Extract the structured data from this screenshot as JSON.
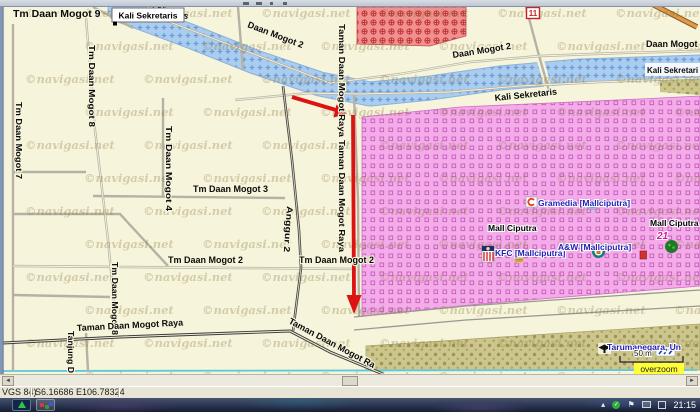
{
  "map": {
    "watermark": "©navigasi.net",
    "tooltip": {
      "label": "Kali Sekretaris"
    },
    "route_shield": "11",
    "river_label_box": {
      "text": "Kali Sekretari"
    },
    "road_labels": [
      {
        "id": "tm-daan-mogot-9",
        "text": "Tm Daan Mogot 9",
        "x": 13,
        "y": 17,
        "rot": 0,
        "size": 10.5
      },
      {
        "id": "kali-sekretaris-top",
        "text": "Kali Sekretaris",
        "x": 128,
        "y": 0,
        "rot": 18,
        "size": 9
      },
      {
        "id": "daan-mogot-2-a",
        "text": "Daan Mogot 2",
        "x": 247,
        "y": 27,
        "rot": 21,
        "size": 9
      },
      {
        "id": "daan-mogot-2-b",
        "text": "Daan Mogot 2",
        "x": 453,
        "y": 58,
        "rot": -9,
        "size": 9
      },
      {
        "id": "daan-mogot-2-c",
        "text": "Daan Mogot 2",
        "x": 646,
        "y": 47,
        "rot": 0,
        "size": 9
      },
      {
        "id": "kali-sekretaris-south",
        "text": "Kali Sekretaris",
        "x": 495,
        "y": 101,
        "rot": -6,
        "size": 9
      },
      {
        "id": "tm-daan-mogot-8-upper",
        "text": "Tm Daan Mogot 8",
        "x": 89,
        "y": 45,
        "rot": 90,
        "size": 8,
        "len": 82
      },
      {
        "id": "tm-daan-mogot-8-lower",
        "text": "Tm Daan Mogot 8",
        "x": 112,
        "y": 262,
        "rot": 90,
        "size": 8,
        "len": 73
      },
      {
        "id": "tm-daan-mogot-7",
        "text": "Tm Daan Mogot 7",
        "x": 16,
        "y": 102,
        "rot": 90,
        "size": 8,
        "len": 77
      },
      {
        "id": "tm-daan-mogot-4",
        "text": "Tm Daan Mogot 4",
        "x": 166,
        "y": 126,
        "rot": 90,
        "size": 8,
        "len": 85
      },
      {
        "id": "tm-daan-mogot-3",
        "text": "Tm Daan Mogot 3",
        "x": 193,
        "y": 192,
        "rot": 0,
        "size": 9
      },
      {
        "id": "tm-daan-mogot-2-a",
        "text": "Tm Daan Mogot 2",
        "x": 168,
        "y": 263,
        "rot": 0,
        "size": 9
      },
      {
        "id": "tm-daan-mogot-2-b",
        "text": "Tm Daan Mogot 2",
        "x": 299,
        "y": 263,
        "rot": 0,
        "size": 9
      },
      {
        "id": "taman-daan-mogot-raya-vert-a",
        "text": "Taman Daan Mogot Raya",
        "x": 339,
        "y": 24,
        "rot": 90,
        "size": 8,
        "len": 113
      },
      {
        "id": "taman-daan-mogot-raya-vert-b",
        "text": "Taman Daan Mogot Raya",
        "x": 339,
        "y": 140,
        "rot": 90,
        "size": 8,
        "len": 112
      },
      {
        "id": "anggur-2",
        "text": "Anggur 2",
        "x": 287,
        "y": 206,
        "rot": 94,
        "size": 8.5,
        "len": 46
      },
      {
        "id": "tanjung-d",
        "text": "Tanjung D",
        "x": 68,
        "y": 331,
        "rot": 90,
        "size": 8,
        "len": 42
      },
      {
        "id": "taman-daan-mogot-raya-horiz",
        "text": "Taman Daan Mogot Raya",
        "x": 77,
        "y": 331,
        "rot": -3,
        "size": 9
      },
      {
        "id": "taman-daan-mogot-raya-diag",
        "text": "Taman Daan Mogot Ra",
        "x": 288,
        "y": 323,
        "rot": 28,
        "size": 9
      }
    ],
    "pois": [
      {
        "id": "gramedia",
        "text": "Gramedia [Mallciputra]",
        "x": 538,
        "y": 206,
        "color": "navy"
      },
      {
        "id": "mall-ciputra-1",
        "text": "Mall Ciputra",
        "x": 488,
        "y": 231,
        "color": "black"
      },
      {
        "id": "kfc",
        "text": "KFC [Mallciputra]",
        "x": 495,
        "y": 256,
        "color": "navy"
      },
      {
        "id": "aw",
        "text": "A&W [Mallciputra]",
        "x": 558,
        "y": 250,
        "color": "navy"
      },
      {
        "id": "mall-ciputra-2",
        "text": "Mall Ciputra",
        "x": 650,
        "y": 226,
        "color": "black"
      },
      {
        "id": "cinema-21",
        "text": "21",
        "x": 657,
        "y": 239,
        "color": "magenta"
      },
      {
        "id": "tarumanegara",
        "text": "Tarumanegara, Un",
        "x": 607,
        "y": 350,
        "color": "navy"
      }
    ],
    "scale": {
      "label": "50 m",
      "overzoom": "overzoom"
    }
  },
  "statusbar": {
    "datum": "VGS 84)",
    "coords": "S6.16686 E106.78324"
  },
  "taskbar": {
    "clock": "21:15"
  }
}
